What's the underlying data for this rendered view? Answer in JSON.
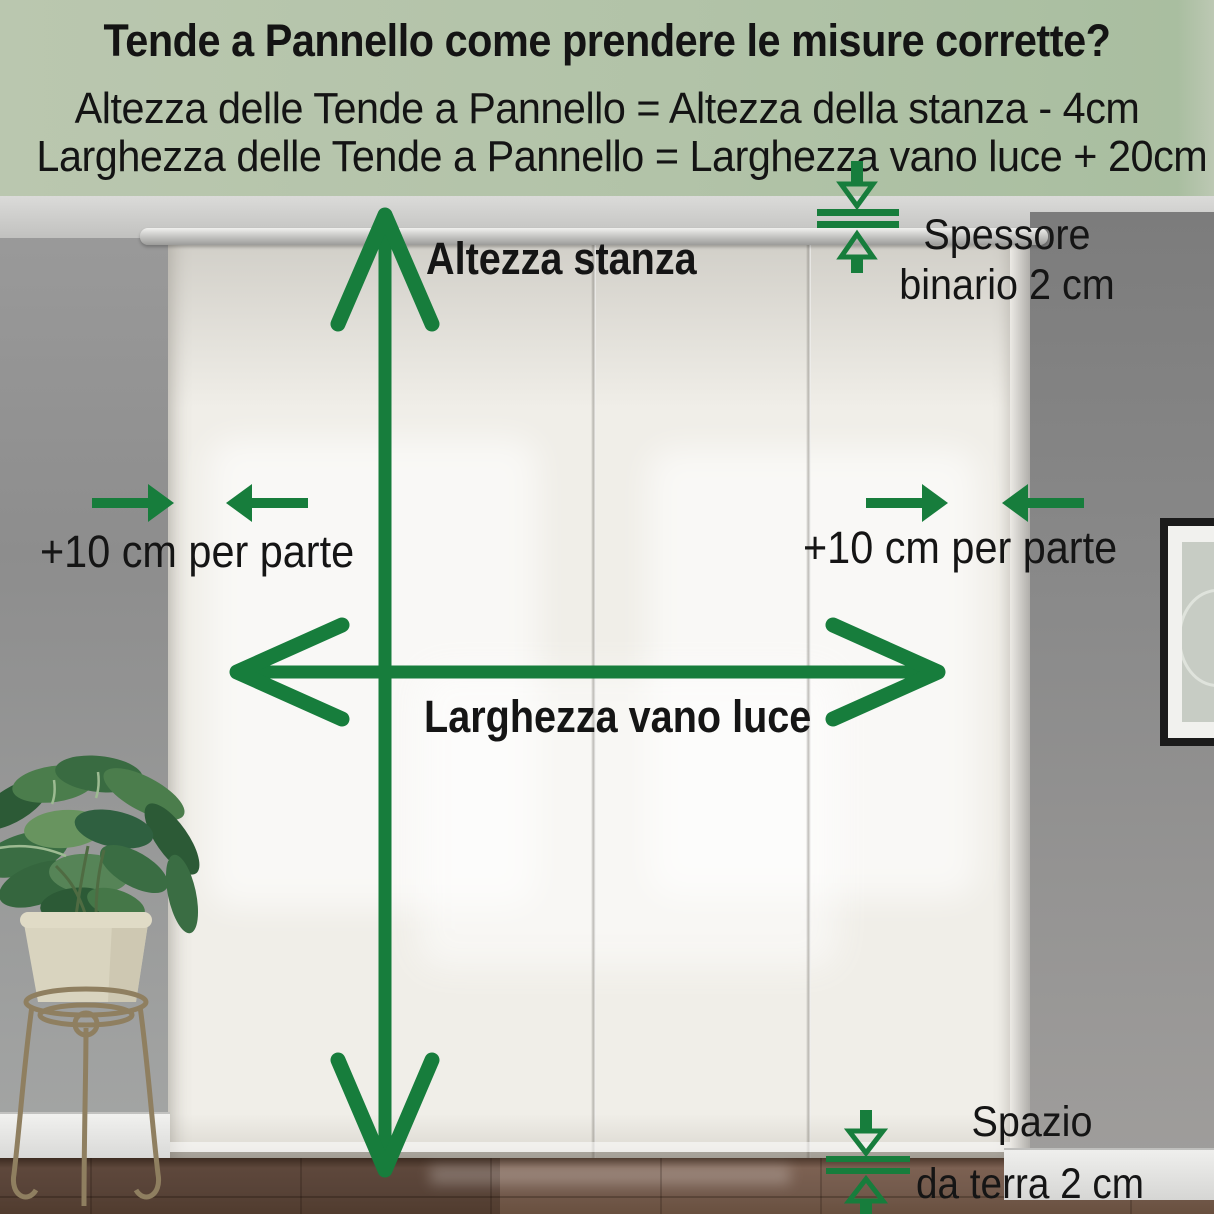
{
  "header": {
    "title": "Tende a Pannello come prendere le misure corrette?",
    "formula_height": "Altezza delle Tende a Pannello = Altezza della stanza - 4cm",
    "formula_width": "Larghezza delle Tende a Pannello = Larghezza vano luce + 20cm"
  },
  "annotations": {
    "room_height_label": "Altezza stanza",
    "opening_width_label": "Larghezza vano luce",
    "left_gap_label": "+10 cm per parte",
    "right_gap_label": "+10 cm per parte",
    "track_label_line1": "Spessore",
    "track_label_line2": "binario 2 cm",
    "floor_label_line1": "Spazio",
    "floor_label_line2": "da terra 2 cm"
  },
  "colors": {
    "accent_green": "#177d3c",
    "header_background": "#b2c3a8",
    "label_text": "#151515",
    "curtain_white": "#f0eee8",
    "wall_gray": "#8d8d8d",
    "floor_brown": "#735a4c"
  }
}
